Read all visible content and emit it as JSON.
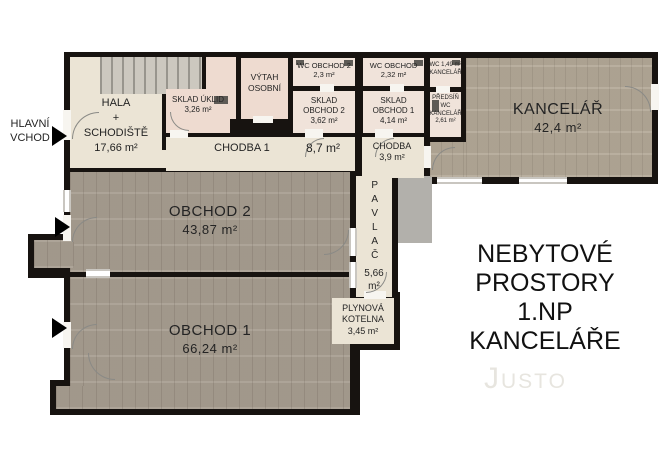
{
  "title": {
    "lines": [
      "NEBYTOVÉ",
      "PROSTORY",
      "1.NP",
      "KANCELÁŘE"
    ]
  },
  "watermark": "Justo",
  "entrance": {
    "line1": "HLAVNÍ",
    "line2": "VCHOD"
  },
  "rooms": {
    "hala": {
      "name": "HALA",
      "plus": "+",
      "name2": "SCHODIŠTĚ",
      "area": "17,66 m²"
    },
    "sklad_uklid": {
      "name": "SKLAD ÚKLID",
      "area": "3,26 m²"
    },
    "vytah": {
      "name": "VÝTAH",
      "name2": "OSOBNÍ"
    },
    "wc_obchod2": {
      "name": "WC OBCHOD 2",
      "area": "2,3 m²"
    },
    "wc_obchod": {
      "name": "WC OBCHOD",
      "area": "2,32 m²"
    },
    "wc_kancelar": {
      "name": "WC 1,49 m²",
      "name2": "KANCELÁŘ"
    },
    "sklad_obchod2": {
      "name": "SKLAD",
      "name2": "OBCHOD 2",
      "area": "3,62 m²"
    },
    "sklad_obchod1": {
      "name": "SKLAD",
      "name2": "OBCHOD 1",
      "area": "4,14 m²"
    },
    "predsin": {
      "name": "PŘEDSÍŇ",
      "name2": "WC",
      "name3": "KANCELÁŘ",
      "area": "2,61 m²"
    },
    "chodba1": {
      "name": "CHODBA 1",
      "area": "8,7 m²"
    },
    "chodba": {
      "name": "CHODBA",
      "area": "3,9 m²"
    },
    "kancelar": {
      "name": "KANCELÁŘ",
      "area": "42,4 m²"
    },
    "obchod2": {
      "name": "OBCHOD 2",
      "area": "43,87 m²"
    },
    "obchod1": {
      "name": "OBCHOD 1",
      "area": "66,24 m²"
    },
    "pavlac": {
      "name": "PAVLAČ",
      "area_line1": "5,66",
      "area_line2": "m²"
    },
    "kotelna": {
      "name": "PLYNOVÁ",
      "name2": "KOTELNA",
      "area": "3,45 m²"
    }
  },
  "colors": {
    "wall": "#171310",
    "floor_beige": "#ebe4d5",
    "floor_pink": "#eedbd0",
    "floor_shop_carpet": "#a79d90",
    "floor_office_carpet": "#b3a897",
    "terrace_gray": "#b2b0ab",
    "stairs_gray": "#ccc8bf"
  }
}
